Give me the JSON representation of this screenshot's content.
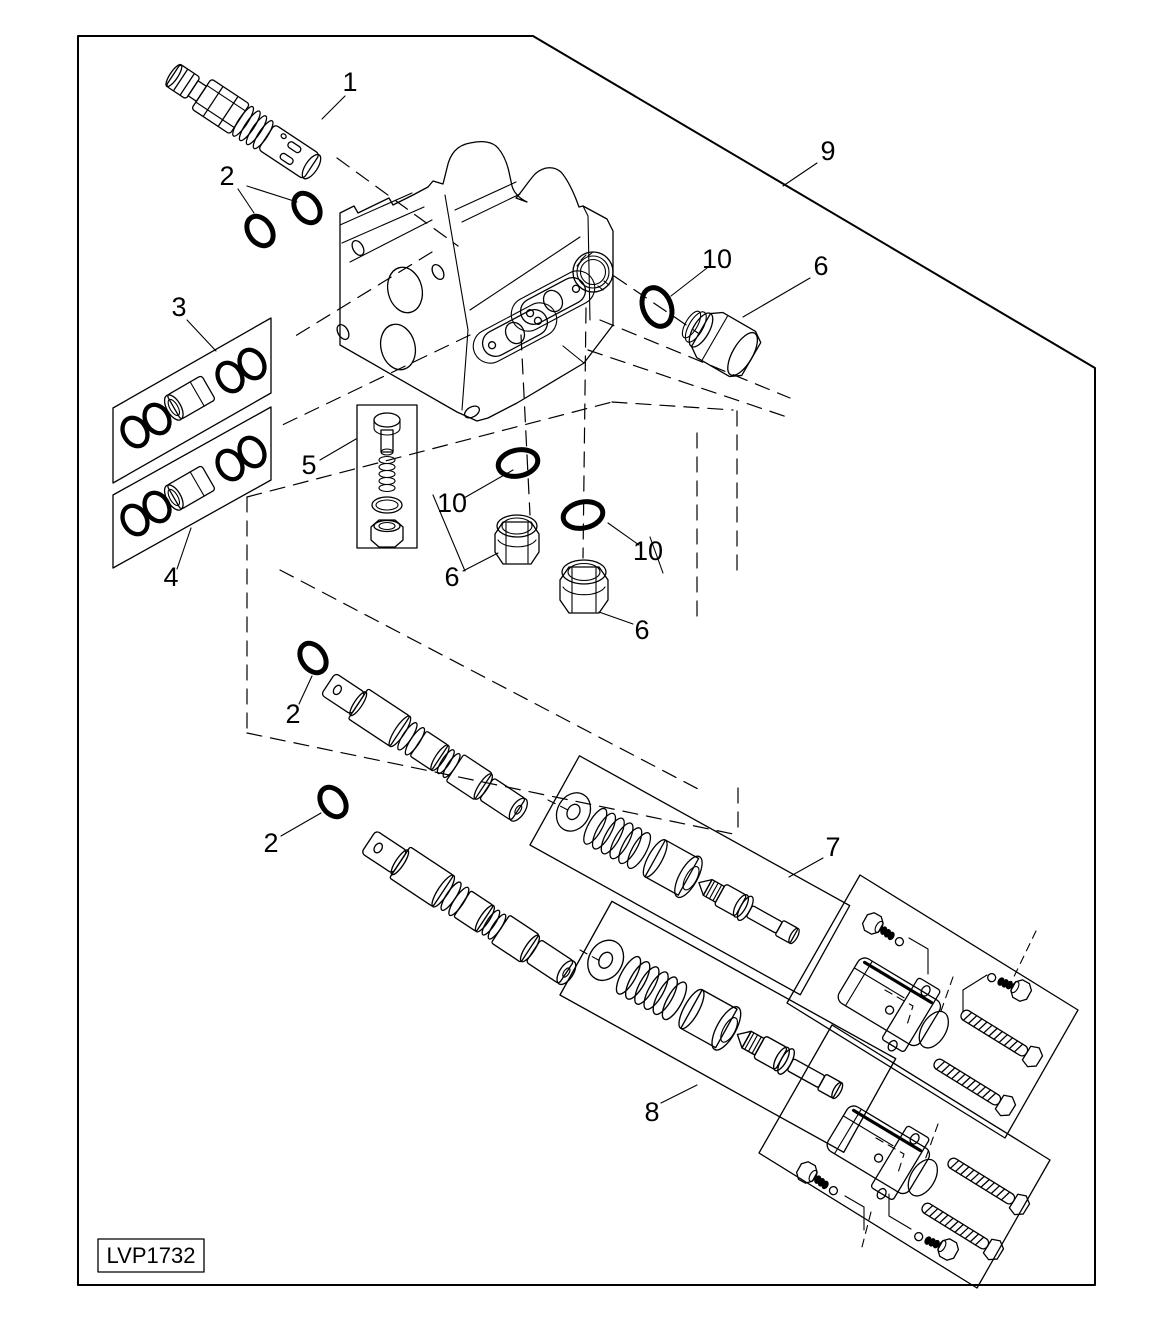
{
  "figure": {
    "code_label": "LVP1732",
    "colors": {
      "line": "#000000",
      "background": "#ffffff"
    },
    "callouts": [
      {
        "label": "1",
        "x": 350,
        "y": 91,
        "leader": [
          345,
          96,
          322,
          119
        ]
      },
      {
        "label": "2",
        "x": 227,
        "y": 185,
        "leader": [
          238,
          189,
          254,
          213
        ]
      },
      {
        "label": "3",
        "x": 179,
        "y": 316,
        "leader": [
          187,
          320,
          216,
          351
        ]
      },
      {
        "label": "4",
        "x": 171,
        "y": 586,
        "leader": [
          177,
          569,
          191,
          528
        ]
      },
      {
        "label": "5",
        "x": 309,
        "y": 474,
        "leader": [
          320,
          460,
          356,
          439
        ]
      },
      {
        "label": "6",
        "x": 452,
        "y": 586,
        "leader": [
          463,
          571,
          498,
          553
        ]
      },
      {
        "label": "6",
        "x": 642,
        "y": 639,
        "leader": [
          633,
          624,
          599,
          612
        ]
      },
      {
        "label": "6",
        "x": 821,
        "y": 275,
        "leader": [
          810,
          278,
          743,
          317
        ]
      },
      {
        "label": "7",
        "x": 833,
        "y": 856,
        "leader": [
          823,
          858,
          789,
          877
        ]
      },
      {
        "label": "8",
        "x": 652,
        "y": 1121,
        "leader": [
          661,
          1103,
          697,
          1085
        ]
      },
      {
        "label": "9",
        "x": 828,
        "y": 160,
        "leader": [
          817,
          163,
          783,
          186
        ]
      },
      {
        "label": "10",
        "x": 452,
        "y": 512,
        "leader": [
          464,
          498,
          513,
          470
        ]
      },
      {
        "label": "10",
        "x": 648,
        "y": 560,
        "leader": [
          639,
          545,
          608,
          523
        ]
      },
      {
        "label": "10",
        "x": 717,
        "y": 268,
        "leader": [
          707,
          268,
          671,
          296
        ]
      },
      {
        "label": "2",
        "x": 293,
        "y": 723,
        "leader": [
          299,
          704,
          312,
          676
        ]
      },
      {
        "label": "2",
        "x": 271,
        "y": 852,
        "leader": [
          281,
          836,
          321,
          813
        ]
      }
    ],
    "extra_leader_lines": [
      [
        247,
        186,
        297,
        202
      ],
      [
        433,
        495,
        465,
        571
      ],
      [
        650,
        537,
        663,
        573
      ]
    ]
  }
}
